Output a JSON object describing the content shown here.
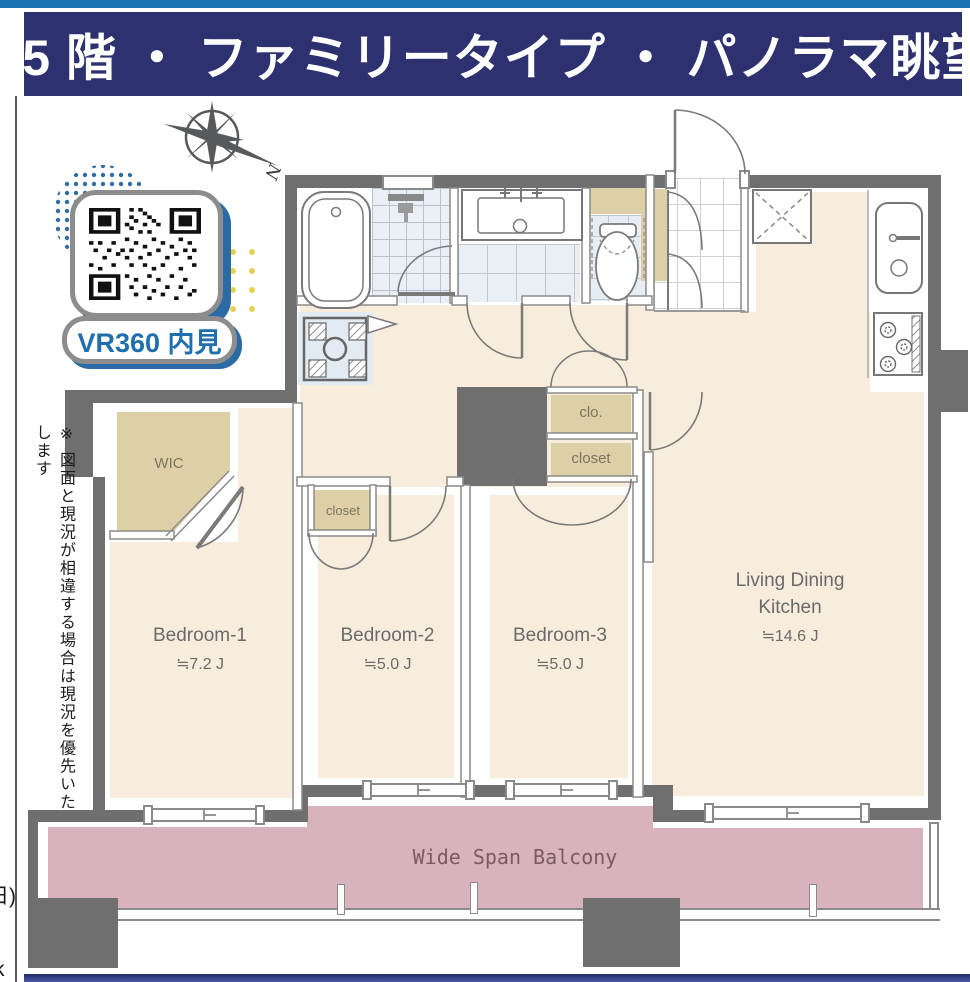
{
  "header": {
    "title": "25 階 ・ ファミリータイプ ・ パノラマ眺望"
  },
  "side_note": "※ 図面と現況が相違する場合は現況を優先いたします",
  "decorations": {
    "qr_label": "VR360 内見",
    "compass_label": "N"
  },
  "edge_fragments": {
    "date_fragment": "日)",
    "letter_fragment": "k"
  },
  "floor_plan": {
    "rooms": [
      {
        "id": "bedroom1",
        "name": "Bedroom-1",
        "size": "≒7.2 J"
      },
      {
        "id": "bedroom2",
        "name": "Bedroom-2",
        "size": "≒5.0 J"
      },
      {
        "id": "bedroom3",
        "name": "Bedroom-3",
        "size": "≒5.0 J"
      },
      {
        "id": "ldk",
        "name_line1": "Living Dining",
        "name_line2": "Kitchen",
        "size": "≒14.6 J"
      }
    ],
    "storage": {
      "wic": "WIC",
      "bedroom2_closet": "closet",
      "bedroom3_clo": "clo.",
      "bedroom3_closet": "closet"
    },
    "balcony": {
      "label": "Wide Span Balcony"
    }
  },
  "colors": {
    "header_bg": "#2d3170",
    "accent_blue": "#1b72b4",
    "wall_gray": "#6f6f6f",
    "floor_beige": "#f8ecdd",
    "storage_tan": "#ddd0a7",
    "balcony_pink": "#d8b2bc",
    "qr_text_blue": "#1f6fae"
  }
}
